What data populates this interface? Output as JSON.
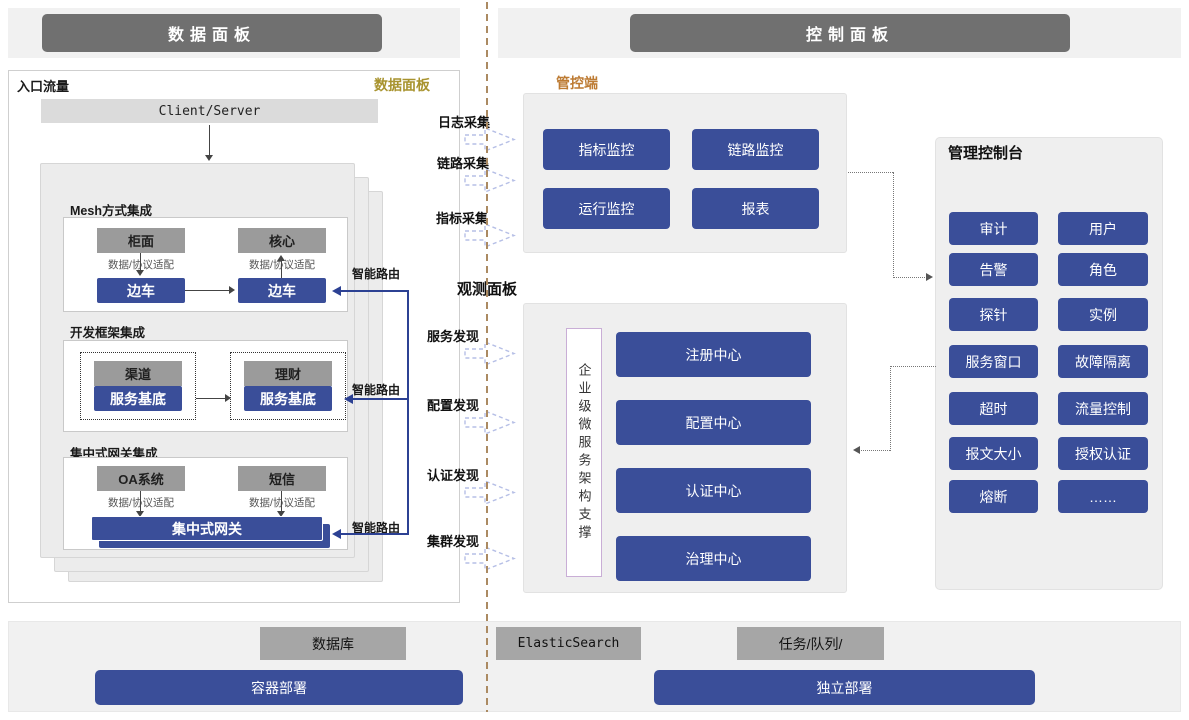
{
  "header": {
    "left_title": "数据面板",
    "right_title": "控制面板"
  },
  "colors": {
    "accent_blue": "#3a4e99",
    "header_gray": "#707070",
    "panel_gray": "#efefef",
    "node_gray": "#9b9b9b",
    "divider_tan": "#ab8a62",
    "gold": "#a8932e",
    "orange": "#bd7b33"
  },
  "data_panel": {
    "corner_label": "入口流量",
    "panel_label": "数据面板",
    "client_server": "Client/Server",
    "smart_route": "智能路由",
    "sections": [
      {
        "title": "Mesh方式集成",
        "top_left": "柜面",
        "top_right": "核心",
        "adapter": "数据/协议适配",
        "bottom_left": "边车",
        "bottom_right": "边车"
      },
      {
        "title": "开发框架集成",
        "top_left": "渠道",
        "top_right": "理财",
        "bottom_left": "服务基底",
        "bottom_right": "服务基底"
      },
      {
        "title": "集中式网关集成",
        "top_left": "OA系统",
        "top_right": "短信",
        "adapter": "数据/协议适配",
        "gateway": "集中式网关"
      }
    ]
  },
  "flows": {
    "collect": [
      "日志采集",
      "链路采集",
      "指标采集"
    ],
    "observe_label": "观测面板",
    "discover": [
      "服务发现",
      "配置发现",
      "认证发现",
      "集群发现"
    ]
  },
  "control_plane": {
    "label": "管控端",
    "monitor_buttons": [
      "指标监控",
      "链路监控",
      "运行监控",
      "报表"
    ],
    "arch_support": "企业级微服务架构支撑",
    "centers": [
      "注册中心",
      "配置中心",
      "认证中心",
      "治理中心"
    ],
    "console": {
      "title": "管理控制台",
      "buttons": [
        "审计",
        "用户",
        "告警",
        "角色",
        "探针",
        "实例",
        "服务窗口",
        "故障隔离",
        "超时",
        "流量控制",
        "报文大小",
        "授权认证",
        "熔断",
        "……"
      ]
    }
  },
  "footer": {
    "db": "数据库",
    "es": "ElasticSearch",
    "queue": "任务/队列/",
    "container": "容器部署",
    "standalone": "独立部署"
  }
}
